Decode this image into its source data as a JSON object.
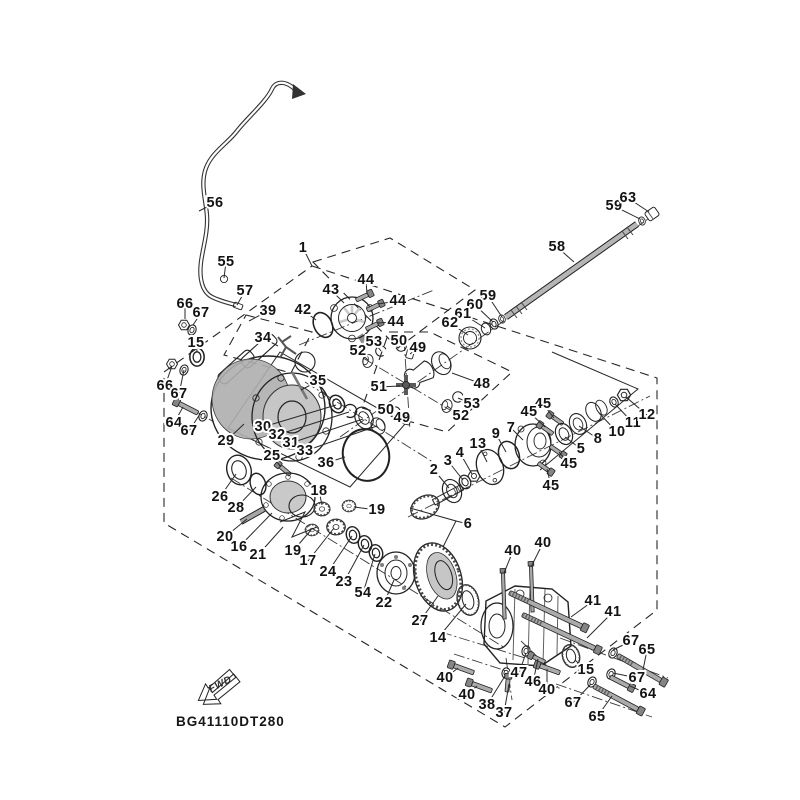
{
  "diagram": {
    "code": "BG41110DT280",
    "direction_label": "FWD",
    "line_color": "#1a1a1a",
    "metal_light": "#d8d8d8",
    "metal_mid": "#b5b5b5",
    "metal_dark": "#8a8a8a",
    "background": "#ffffff"
  },
  "callout_fields": [
    "part_no",
    "x",
    "y",
    "target_x",
    "target_y"
  ],
  "callouts": [
    [
      "1",
      303,
      248,
      312,
      266
    ],
    [
      "56",
      215,
      203,
      199,
      211
    ],
    [
      "55",
      226,
      262,
      224,
      278
    ],
    [
      "57",
      245,
      291,
      237,
      305
    ],
    [
      "66",
      185,
      304,
      185,
      319
    ],
    [
      "67",
      201,
      313,
      193,
      325
    ],
    [
      "39",
      268,
      311,
      249,
      321
    ],
    [
      "42",
      303,
      310,
      316,
      320
    ],
    [
      "43",
      331,
      290,
      344,
      303
    ],
    [
      "44",
      366,
      280,
      367,
      294
    ],
    [
      "44",
      398,
      301,
      378,
      304
    ],
    [
      "44",
      396,
      322,
      377,
      323
    ],
    [
      "34",
      263,
      338,
      278,
      346
    ],
    [
      "15",
      196,
      343,
      197,
      352
    ],
    [
      "35",
      318,
      381,
      301,
      390
    ],
    [
      "66",
      165,
      386,
      172,
      366
    ],
    [
      "67",
      179,
      394,
      184,
      370
    ],
    [
      "64",
      174,
      423,
      183,
      407
    ],
    [
      "67",
      189,
      431,
      200,
      414
    ],
    [
      "29",
      226,
      441,
      244,
      424
    ],
    [
      "30",
      263,
      427,
      336,
      405
    ],
    [
      "32",
      277,
      435,
      349,
      412
    ],
    [
      "31",
      291,
      443,
      363,
      419
    ],
    [
      "33",
      305,
      451,
      377,
      426
    ],
    [
      "36",
      326,
      463,
      345,
      457
    ],
    [
      "25",
      272,
      456,
      281,
      467
    ],
    [
      "26",
      220,
      497,
      236,
      474
    ],
    [
      "28",
      236,
      508,
      256,
      487
    ],
    [
      "20",
      225,
      537,
      247,
      519
    ],
    [
      "16",
      239,
      547,
      272,
      513
    ],
    [
      "21",
      258,
      555,
      283,
      527
    ],
    [
      "18",
      319,
      491,
      322,
      505
    ],
    [
      "19",
      377,
      510,
      354,
      507
    ],
    [
      "19",
      293,
      551,
      311,
      530
    ],
    [
      "17",
      308,
      561,
      334,
      528
    ],
    [
      "24",
      328,
      572,
      352,
      536
    ],
    [
      "23",
      344,
      582,
      364,
      545
    ],
    [
      "54",
      363,
      593,
      375,
      554
    ],
    [
      "22",
      384,
      603,
      394,
      580
    ],
    [
      "27",
      420,
      621,
      438,
      596
    ],
    [
      "14",
      438,
      638,
      466,
      604
    ],
    [
      "2",
      434,
      470,
      449,
      488
    ],
    [
      "3",
      448,
      461,
      463,
      480
    ],
    [
      "4",
      460,
      453,
      472,
      474
    ],
    [
      "13",
      478,
      444,
      487,
      462
    ],
    [
      "9",
      496,
      434,
      506,
      452
    ],
    [
      "7",
      511,
      428,
      523,
      440
    ],
    [
      "45",
      543,
      404,
      554,
      418
    ],
    [
      "45",
      529,
      412,
      545,
      427
    ],
    [
      "45",
      569,
      464,
      559,
      452
    ],
    [
      "45",
      551,
      486,
      547,
      469
    ],
    [
      "5",
      581,
      449,
      565,
      437
    ],
    [
      "8",
      598,
      439,
      579,
      426
    ],
    [
      "10",
      617,
      432,
      599,
      413
    ],
    [
      "11",
      633,
      423,
      615,
      404
    ],
    [
      "12",
      647,
      415,
      626,
      397
    ],
    [
      "6",
      468,
      524,
      456,
      521
    ],
    [
      "53",
      374,
      342,
      381,
      351
    ],
    [
      "52",
      358,
      351,
      368,
      360
    ],
    [
      "50",
      399,
      341,
      402,
      347
    ],
    [
      "49",
      418,
      348,
      410,
      354
    ],
    [
      "51",
      379,
      387,
      400,
      386
    ],
    [
      "48",
      482,
      384,
      452,
      373
    ],
    [
      "50",
      386,
      410,
      395,
      412
    ],
    [
      "49",
      402,
      418,
      406,
      419
    ],
    [
      "53",
      472,
      404,
      458,
      398
    ],
    [
      "52",
      461,
      416,
      447,
      406
    ],
    [
      "58",
      557,
      247,
      574,
      262
    ],
    [
      "59",
      614,
      206,
      640,
      219
    ],
    [
      "63",
      628,
      198,
      649,
      212
    ],
    [
      "59",
      488,
      296,
      502,
      317
    ],
    [
      "60",
      475,
      305,
      493,
      322
    ],
    [
      "61",
      463,
      314,
      485,
      328
    ],
    [
      "62",
      450,
      323,
      468,
      335
    ],
    [
      "40",
      513,
      551,
      504,
      573
    ],
    [
      "40",
      543,
      543,
      531,
      567
    ],
    [
      "41",
      593,
      601,
      571,
      617
    ],
    [
      "41",
      613,
      612,
      587,
      638
    ],
    [
      "67",
      631,
      641,
      613,
      650
    ],
    [
      "65",
      647,
      650,
      643,
      670
    ],
    [
      "15",
      586,
      670,
      575,
      660
    ],
    [
      "67",
      637,
      678,
      613,
      673
    ],
    [
      "64",
      648,
      694,
      630,
      686
    ],
    [
      "47",
      519,
      673,
      526,
      653
    ],
    [
      "46",
      533,
      682,
      538,
      659
    ],
    [
      "40",
      547,
      690,
      547,
      669
    ],
    [
      "40",
      445,
      678,
      458,
      668
    ],
    [
      "40",
      467,
      695,
      477,
      686
    ],
    [
      "38",
      487,
      705,
      505,
      676
    ],
    [
      "37",
      504,
      713,
      509,
      684
    ],
    [
      "67",
      573,
      703,
      591,
      684
    ],
    [
      "65",
      597,
      717,
      612,
      696
    ]
  ]
}
